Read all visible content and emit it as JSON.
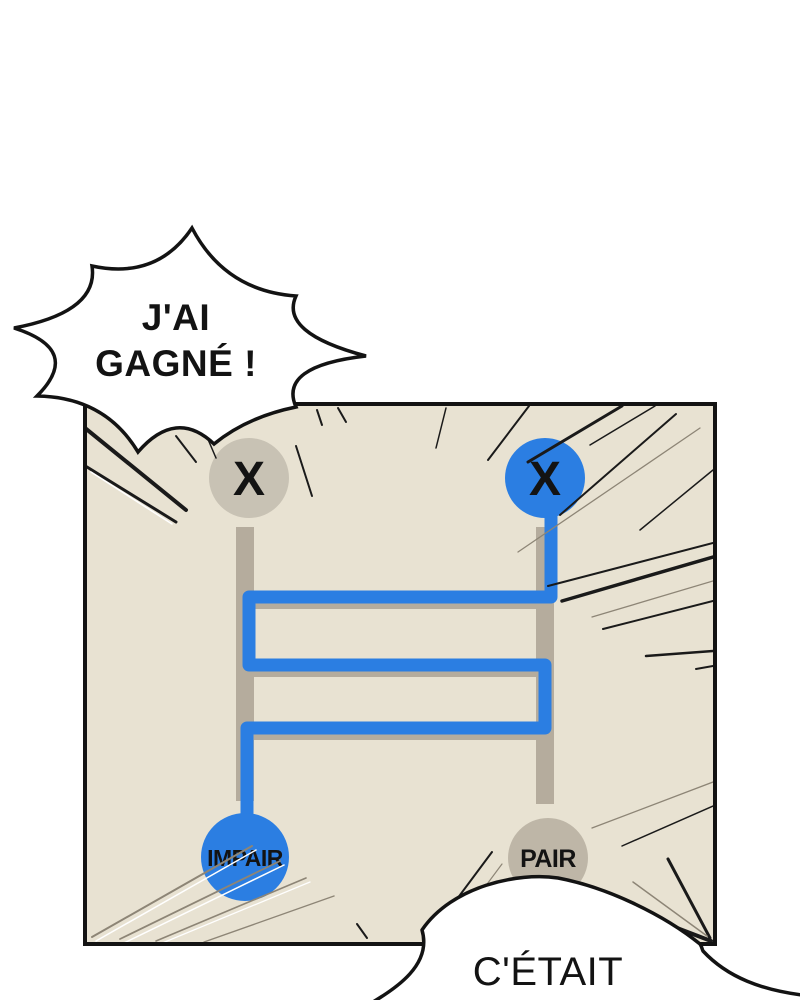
{
  "scene": {
    "panel": {
      "background": "#e8e2d2",
      "border_color": "#131313"
    },
    "colors": {
      "blue": "#2b7ee2",
      "rail_gray": "#b5ac9d",
      "node_gray": "#c8c2b4",
      "pair_gray": "#beb6a7",
      "bubble_fill": "#ffffff",
      "outline": "#131313",
      "speedline_dark": "#1a1a1a",
      "speedline_soft": "#8d8576",
      "speedline_light": "#ffffff"
    }
  },
  "bubbles": {
    "shout": {
      "line1": "J'AI",
      "line2": "GAGNÉ !"
    },
    "bottom": {
      "text": "C'ÉTAIT"
    }
  },
  "ladder": {
    "top_left": {
      "label": "X"
    },
    "top_right": {
      "label": "X"
    },
    "bottom_left": {
      "label": "IMPAIR"
    },
    "bottom_right": {
      "label": "PAIR"
    }
  }
}
